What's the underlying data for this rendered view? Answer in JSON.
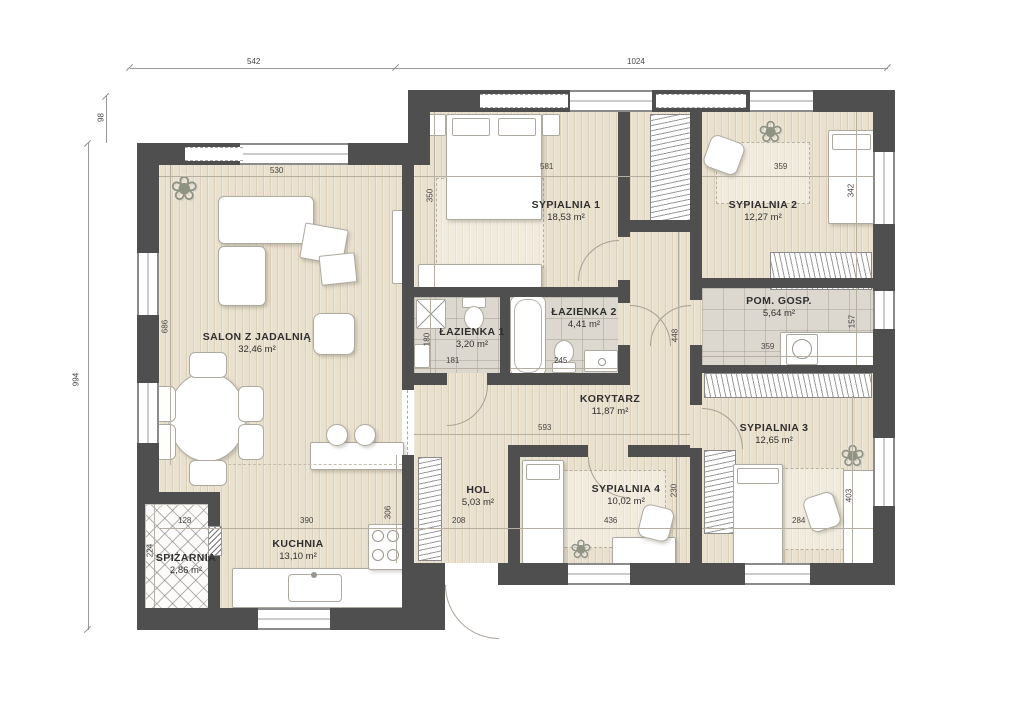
{
  "plan": {
    "rooms": {
      "salon": {
        "name": "SALON Z JADALNIĄ",
        "area": "32,46 m²"
      },
      "sypialnia1": {
        "name": "SYPIALNIA 1",
        "area": "18,53 m²"
      },
      "sypialnia2": {
        "name": "SYPIALNIA 2",
        "area": "12,27 m²"
      },
      "lazienka1": {
        "name": "ŁAZIENKA 1",
        "area": "3,20 m²"
      },
      "lazienka2": {
        "name": "ŁAZIENKA 2",
        "area": "4,41 m²"
      },
      "pomgosp": {
        "name": "POM. GOSP.",
        "area": "5,64 m²"
      },
      "korytarz": {
        "name": "KORYTARZ",
        "area": "11,87 m²"
      },
      "sypialnia3": {
        "name": "SYPIALNIA 3",
        "area": "12,65 m²"
      },
      "sypialnia4": {
        "name": "SYPIALNIA 4",
        "area": "10,02 m²"
      },
      "hol": {
        "name": "HOL",
        "area": "5,03 m²"
      },
      "kuchnia": {
        "name": "KUCHNIA",
        "area": "13,10 m²"
      },
      "spizarnia": {
        "name": "SPIŻARNIA",
        "area": "2,86 m²"
      }
    },
    "dims": {
      "top_w_left": "542",
      "top_w_right": "1024",
      "left_offset": "98",
      "left_total": "994",
      "salon_w": "530",
      "salon_h": "686",
      "s1_w": "581",
      "s1_h": "350",
      "s2_w": "359",
      "s2_h": "342",
      "laz1_w": "181",
      "laz1_h": "180",
      "laz2_w": "245",
      "kor_w": "593",
      "kor_h": "448",
      "pg_w": "359",
      "pg_h": "157",
      "s3_w": "284",
      "s3_h": "403",
      "s4_w": "436",
      "s4_h": "230",
      "hol_w": "208",
      "hol_h": "306",
      "kuch_w": "390",
      "spiz_w": "128",
      "spiz_h": "224"
    },
    "icons": {
      "plant": "❀"
    },
    "colors": {
      "wall": "#4f4f4f",
      "wood_floor": "#e9e0ce",
      "tile_floor": "#dcd8cf",
      "dimension_text": "#454545"
    }
  }
}
